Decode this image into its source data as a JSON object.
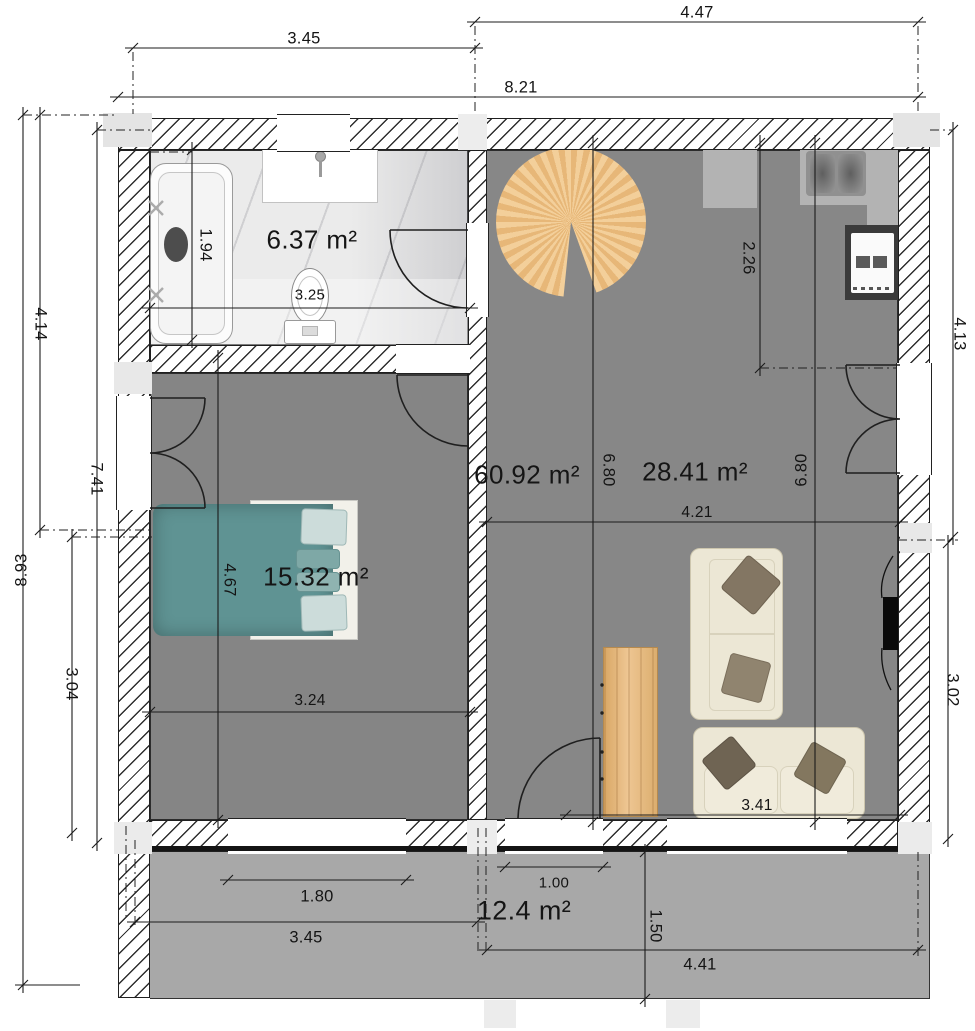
{
  "plan": {
    "rooms": {
      "bathroom": "6.37 m²",
      "living_zone": "60.92 m²",
      "living": "28.41 m²",
      "bedroom": "15.32 m²",
      "terrace": "12.4 m²"
    },
    "dims": {
      "top_partial": "4.47",
      "top_bath": "3.45",
      "top_total": "8.21",
      "left_total": "8.93",
      "left_upper": "4.14",
      "left_inner": "7.41",
      "left_lower": "3.04",
      "bath_height": "1.94",
      "bath_width": "3.25",
      "kitchen_depth": "2.26",
      "right_upper": "4.13",
      "living_height_left": "6.80",
      "living_height_right": "6.80",
      "living_width": "4.21",
      "bedroom_height": "4.67",
      "bedroom_width": "3.24",
      "right_lower": "3.02",
      "sofa_span": "3.41",
      "bedroom_window_width": "1.80",
      "terrace_left_width": "3.45",
      "entrance_width": "1.00",
      "terrace_depth": "1.50",
      "terrace_right_width": "4.41"
    },
    "colors": {
      "room_floor": "#878787",
      "bedroom_floor": "#858585",
      "terrace_floor": "#a8a8a8",
      "marble": "#ebebeb",
      "counter": "#b3b3b3",
      "wood": "#e8b97c",
      "bed_teal": "#5f9393",
      "sofa_cream": "#ece7d5",
      "stove_body": "#3a3a3a",
      "tv": "#0a0a0a"
    }
  }
}
